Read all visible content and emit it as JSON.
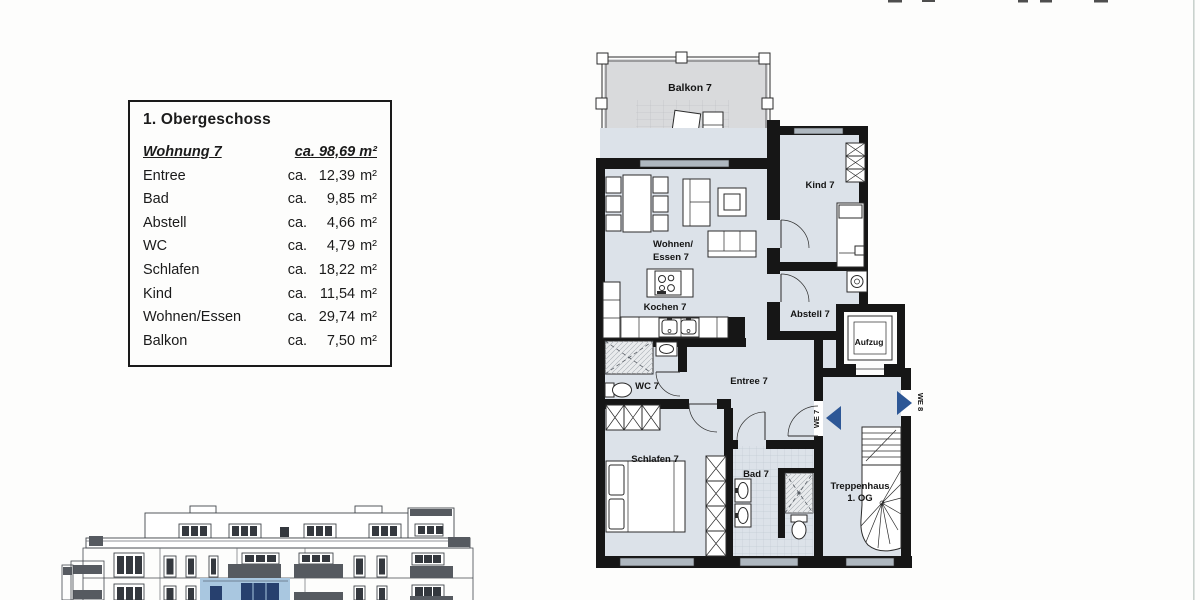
{
  "legend": {
    "title": "1. Obergeschoss",
    "unit_prefix": "ca.",
    "unit": "m²",
    "apartment": {
      "label": "Wohnung 7",
      "area": "ca. 98,69 m²"
    },
    "rows": [
      {
        "label": "Entree",
        "area": "12,39"
      },
      {
        "label": "Bad",
        "area": "9,85"
      },
      {
        "label": "Abstell",
        "area": "4,66"
      },
      {
        "label": "WC",
        "area": "4,79"
      },
      {
        "label": "Schlafen",
        "area": "18,22"
      },
      {
        "label": "Kind",
        "area": "11,54"
      },
      {
        "label": "Wohnen/Essen",
        "area": "29,74"
      },
      {
        "label": "Balkon",
        "area": "7,50"
      }
    ]
  },
  "floorplan": {
    "labels": {
      "balkon": "Balkon 7",
      "wohnen1": "Wohnen/",
      "wohnen2": "Essen 7",
      "kochen": "Kochen 7",
      "kind": "Kind 7",
      "abstell": "Abstell 7",
      "entree": "Entree 7",
      "wc": "WC 7",
      "schlafen": "Schlafen 7",
      "bad": "Bad 7",
      "aufzug": "Aufzug",
      "trepp1": "Treppenhaus",
      "trepp2": "1. OG",
      "we7": "WE 7",
      "we8": "WE 8"
    },
    "colors": {
      "wall": "#161616",
      "room_fill": "#dce2e9",
      "balcony_fill": "#d9dadc",
      "window_glass": "#aeb7bf",
      "entry_arrow": "#2d5796",
      "elevation_highlight": "#a9c7e0",
      "elevation_window": "#27406e"
    }
  }
}
